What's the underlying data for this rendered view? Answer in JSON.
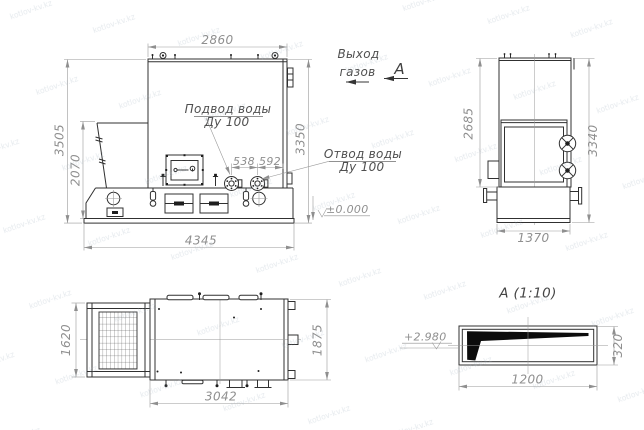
{
  "palette": {
    "background": "#ffffff",
    "linework": "#303030",
    "dimension_text": "#8f8f8f",
    "label_text": "#4f4f4f",
    "section_fill": "#0c0c0c",
    "watermark": "#9fb0bd"
  },
  "watermark": {
    "text": "kotlov-kv.kz"
  },
  "front_view": {
    "dim_top": "2860",
    "dim_left_outer": "3505",
    "dim_left_inner": "2070",
    "dim_right": "3350",
    "dim_bottom": "4345",
    "dim_flange_a": "538",
    "dim_flange_b": "592",
    "label_inlet_line1": "Подвод воды",
    "label_inlet_line2": "Ду 100",
    "label_outlet_line1": "Отвод воды",
    "label_outlet_line2": "Ду 100",
    "label_ground_level": "±0.000"
  },
  "side_view": {
    "dim_height_inner": "2685",
    "dim_height_outer": "3340",
    "dim_width_bottom": "1370",
    "label_gas_exit_line1": "Выход",
    "label_gas_exit_line2": "газов",
    "label_view_arrow": "А"
  },
  "plan_view": {
    "dim_left": "1620",
    "dim_right": "1875",
    "dim_bottom": "3042"
  },
  "detail_view": {
    "title": "А (1:10)",
    "dim_width": "1200",
    "dim_height": "320",
    "label_elevation": "+2.980"
  }
}
